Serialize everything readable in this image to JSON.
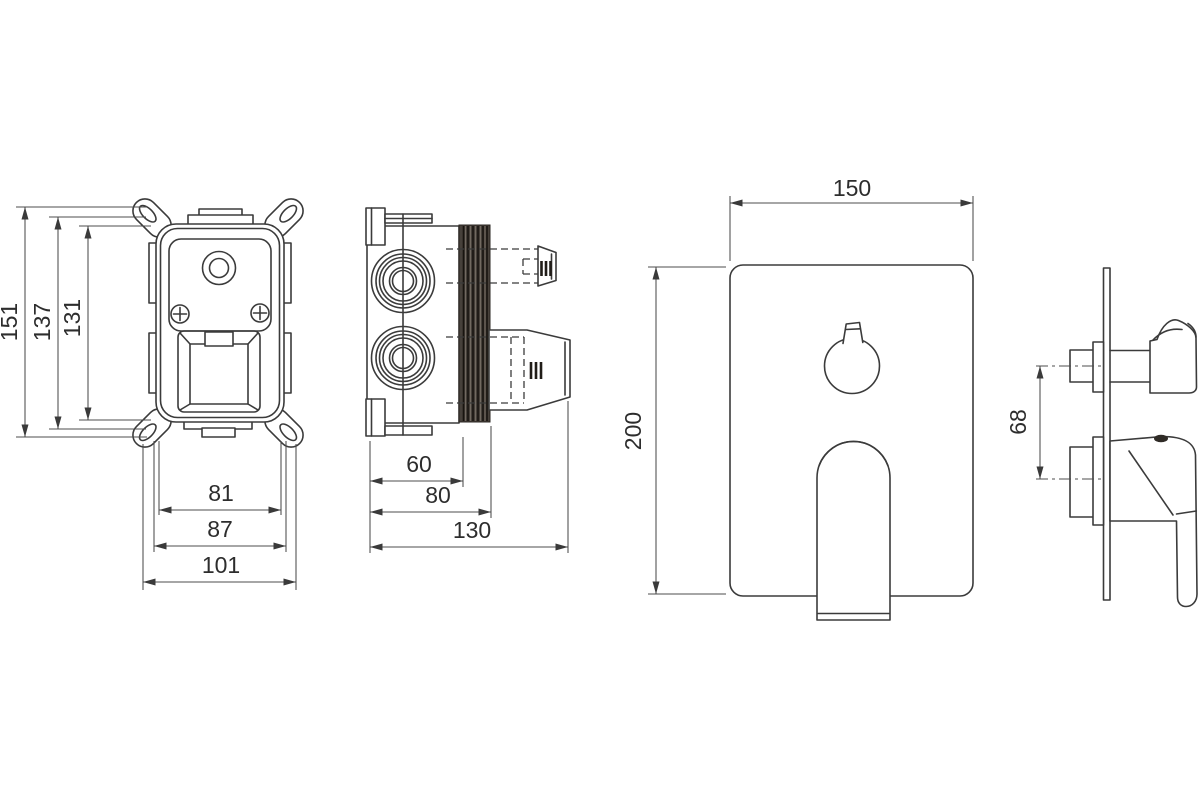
{
  "colors": {
    "background": "#ffffff",
    "line": "#3b3b3b",
    "text": "#2d2d2d",
    "seal_band": "#46403a"
  },
  "views": {
    "valve_front": {
      "dims": {
        "overall_height": "151",
        "body_height": "137",
        "inner_height": "131",
        "inner_width": "81",
        "body_width": "87",
        "overall_width": "101"
      }
    },
    "valve_side": {
      "dims": {
        "box_depth": "60",
        "flange_depth": "80",
        "overall_depth": "130"
      }
    },
    "trim_front": {
      "dims": {
        "plate_width": "150",
        "plate_height": "200"
      }
    },
    "trim_side": {
      "dims": {
        "handle_offset": "68"
      }
    }
  }
}
